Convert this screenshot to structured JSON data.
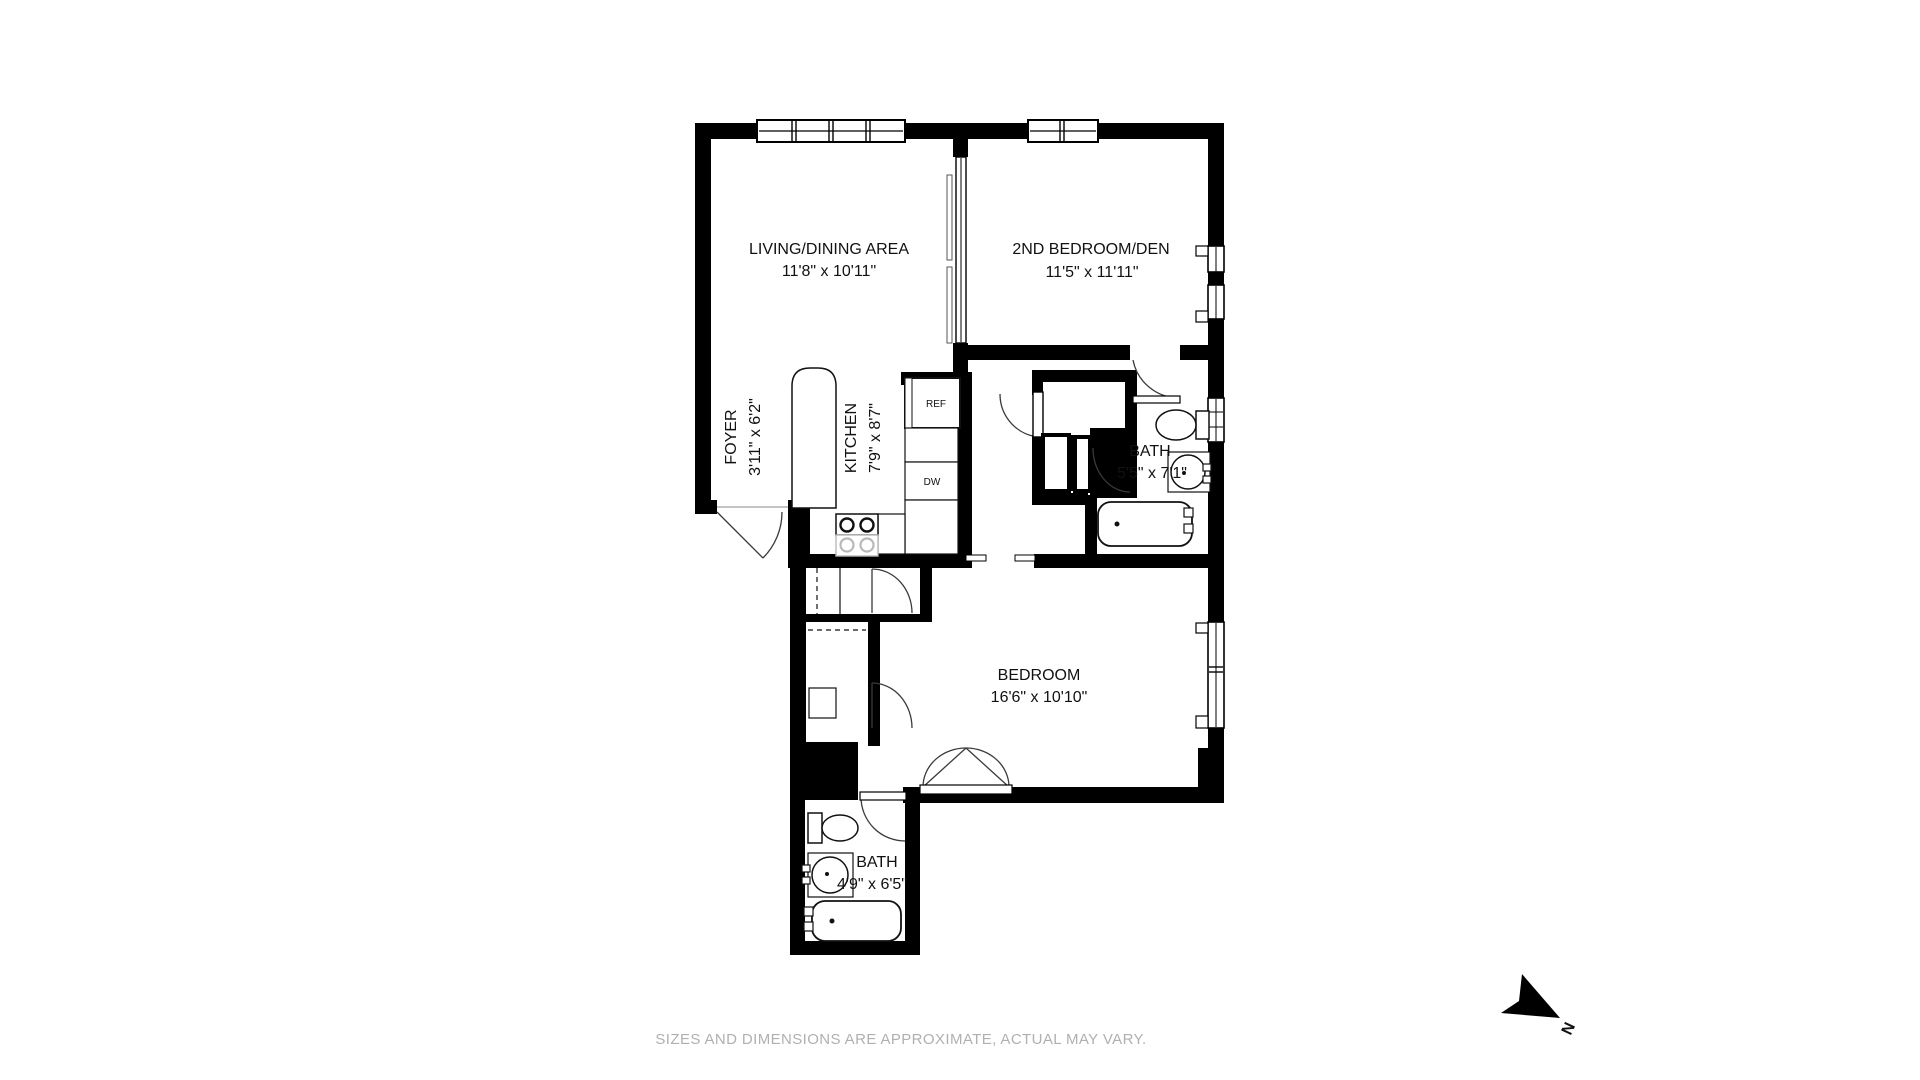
{
  "title": "Apartment floor plan",
  "colors": {
    "wall": "#000000",
    "background": "#ffffff",
    "fixture_line": "#111111",
    "light_line": "#b9b9b9",
    "disclaimer_text": "#b0b0b0"
  },
  "rooms": {
    "living_dining": {
      "name": "LIVING/DINING AREA",
      "dims": "11'8\" x 10'11\""
    },
    "second_bedroom": {
      "name": "2ND BEDROOM/DEN",
      "dims": "11'5\" x 11'11\""
    },
    "foyer": {
      "name": "FOYER",
      "dims": "3'11\" x 6'2\""
    },
    "kitchen": {
      "name": "KITCHEN",
      "dims": "7'9\" x 8'7\""
    },
    "bath_upper": {
      "name": "BATH",
      "dims": "5'5\" x 7'1\""
    },
    "bedroom": {
      "name": "BEDROOM",
      "dims": "16'6\" x 10'10\""
    },
    "bath_lower": {
      "name": "BATH",
      "dims": "4'9\" x 6'5\""
    }
  },
  "appliances": {
    "refrigerator": "REF",
    "dishwasher": "DW"
  },
  "compass": {
    "label": "N"
  },
  "footer": {
    "disclaimer": "SIZES AND DIMENSIONS ARE APPROXIMATE, ACTUAL MAY VARY."
  }
}
